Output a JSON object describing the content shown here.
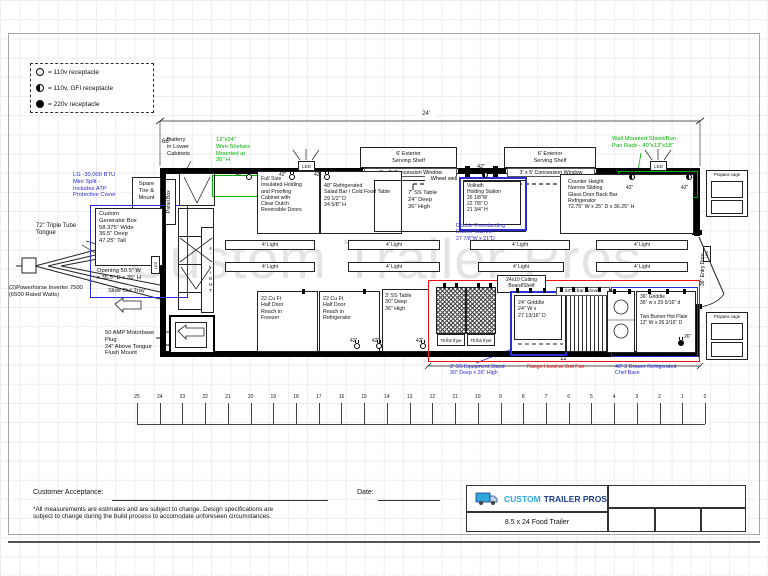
{
  "legend": {
    "items": [
      {
        "type": "open",
        "label": "= 110v receptacle"
      },
      {
        "type": "gfi",
        "label": "= 110v, GFI receptacle"
      },
      {
        "type": "full",
        "label": "= 220v receptacle"
      }
    ]
  },
  "dims": {
    "length": "24'",
    "front": "66\"",
    "hood": "12'"
  },
  "recep": {
    "r42": "42\"",
    "r26": "26\""
  },
  "exterior": {
    "battery": "Battery\nin Lower\nCabinets",
    "wire_shelves": "12\"x24\"\nWire Shelves\nMounted at\n36\" H",
    "serving_shelf": "6' Exterior\nServing Shelf",
    "concession_window": "3' x 5' Concession Window",
    "pan_rack": "Wall Mounted Sheet/Bun\nPan Rack - 40\"x13\"x18\"",
    "led": "LED",
    "propane": "Propane cage",
    "entry_door": "36\" Entry Door",
    "mini_split": "LG -30,000 BTU\nMini Split -\nIncludes ATP\nProtective Cover",
    "spare_tire": "Spare\nTire &\nMount",
    "tongue": "72\" Triple Tube\nTongue",
    "inverter": "(2)Powerhorse Inverter 7500\n(6500 Rated Watts)",
    "motorbase": "50 AMP Motorbase Plug\n24\" Above Tongue\nFlush Mount"
  },
  "generator": {
    "title": "Custom\nGenerator Box\n58.375\" Wide\n36.5\" Deep\n47.25\" Tall",
    "opening": "Opening 50.5\" W\nx 35.5\" D x 35\" H",
    "slide": "Slide Out Tray"
  },
  "interior": {
    "panel_box": "Panel Box",
    "light": "4' Light",
    "light_vert": "4' LIGHT",
    "wheel_well": "Wheel well",
    "holding_cabinet": "Full Size\nInsulated Holding\nand Proofing\nCabinet with\nClear Dutch\nReversible Doors",
    "salad_bar": "48\" Refrigerated\nSalad Bar / Cold Food Table\n29 1/2\" D\n34 5/8\" H",
    "ss_table_7": "7' SS Table\n24\" Deep\n36\" High",
    "holding_station": "Vollrath\nHolding Station\n26 1/8\"W\n22 7/8\" D\n21 3/4\" H",
    "drawer_warmer": "Double Freestanding\nDrawer Warmer\n27 7/8\"W x 21\"D",
    "back_bar": "Counter Height\nNarrow Sliding\nGlass Door Back Bar\nRefrigerator\n72.75\" W x 25\" D x 36.25\" H",
    "freezer": "22 Cu Ft\nHalf Door\nReach in\nFreezer",
    "refrigerator": "22 Cu Ft\nHalf Door\nReach in\nRefrigerator",
    "ss_table_3": "3' SS Table\n30\" Deep\n36\" High",
    "fryer": "70 lbs fryer",
    "cutting_board": "24x10 Cutting\nBoard/Shelf",
    "griddle_24": "24\" Griddle\n24\" W x\n27 13/16\" D",
    "charbroiler": "24\" Char. w/oven",
    "griddle_36": "36\" Griddle\n36\" w x 29 5/16\" d",
    "hot_plate": "Two Burner Hot Plate\n12\" W x 26 3/16\" D",
    "equipment_stand": "2' SS Equipment Stand\n30\" Deep x 26\" High",
    "range_hood": "Range Hood w/ 2nd Fan",
    "chef_base": "48\" 2 Drawer Refrigerated\nChef Base"
  },
  "ruler": {
    "marks": [
      "25",
      "24",
      "23",
      "22",
      "21",
      "20",
      "19",
      "18",
      "17",
      "16",
      "15",
      "14",
      "13",
      "12",
      "11",
      "10",
      "9",
      "8",
      "7",
      "6",
      "5",
      "4",
      "3",
      "2",
      "1",
      "0"
    ]
  },
  "footer": {
    "customer": "Customer Acceptance:",
    "date": "Date:",
    "disclaimer": "*All measurements are estimates and are subject to change. Design specifications are\nsubject to change during the build process to accomodate unforeseen circumstances.",
    "brand_1": "CUSTOM",
    "brand_2": "TRAILER PROS",
    "product": "8.5 x 24 Food Trailer"
  },
  "watermark": "Custom Trailer Pros",
  "colors": {
    "annotation_blue": "#2b2bd6",
    "annotation_green": "#00b400",
    "annotation_red": "#ee1111",
    "logo_light_blue": "#2fa8dc",
    "logo_dark_blue": "#1d3d8f"
  }
}
